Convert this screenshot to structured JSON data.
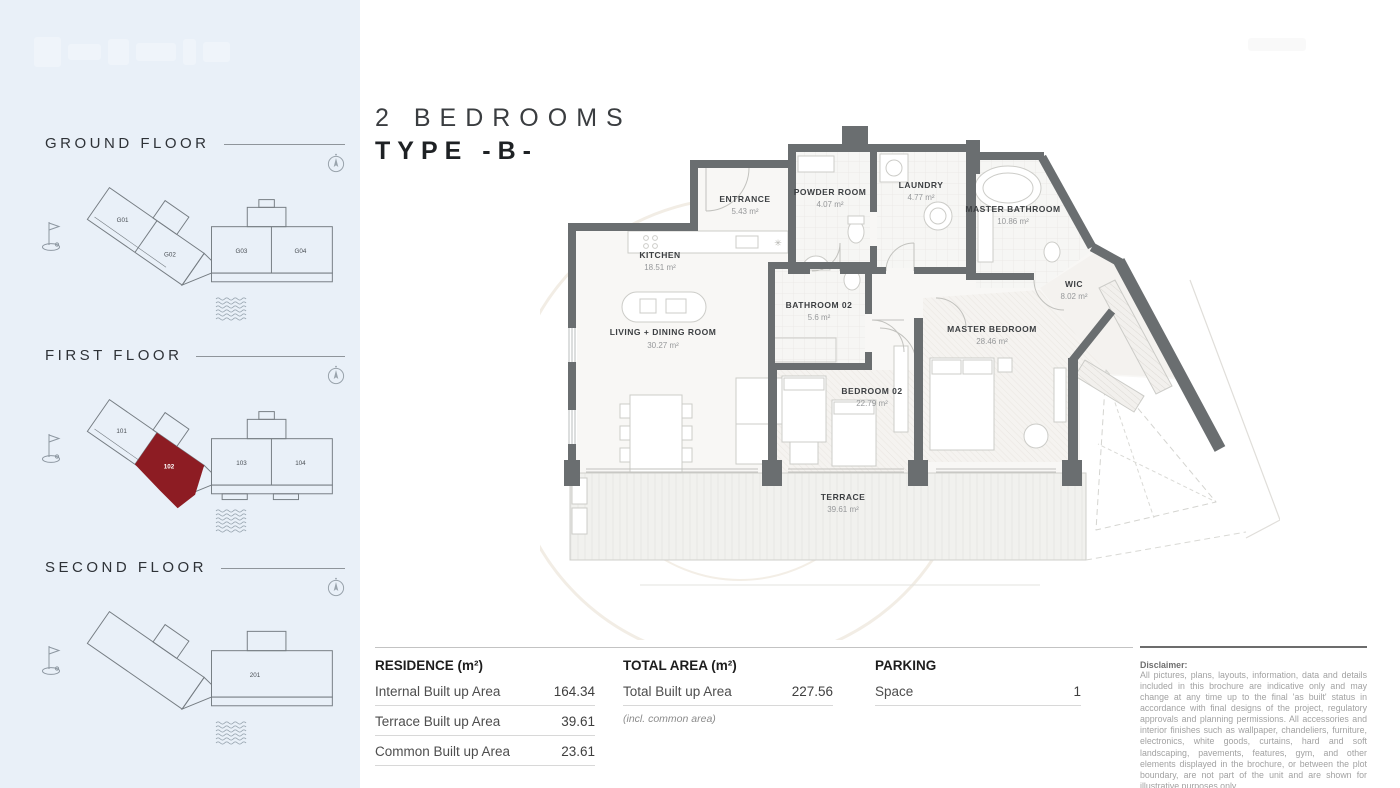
{
  "title": {
    "line1": "2 BEDROOMS",
    "line2": "TYPE -B-"
  },
  "sidebar": {
    "floors": [
      {
        "label": "GROUND FLOOR",
        "units": [
          "G01",
          "G02",
          "G03",
          "G04"
        ],
        "highlighted_unit": ""
      },
      {
        "label": "FIRST FLOOR",
        "units": [
          "101",
          "102",
          "103",
          "104"
        ],
        "highlighted_unit": "102"
      },
      {
        "label": "SECOND FLOOR",
        "units": [
          "201"
        ],
        "highlighted_unit": ""
      }
    ]
  },
  "floorplan": {
    "rooms": [
      {
        "name": "ENTRANCE",
        "area": "5.43 m²"
      },
      {
        "name": "POWDER ROOM",
        "area": "4.07 m²"
      },
      {
        "name": "LAUNDRY",
        "area": "4.77 m²"
      },
      {
        "name": "MASTER BATHROOM",
        "area": "10.86 m²"
      },
      {
        "name": "KITCHEN",
        "area": "18.51 m²"
      },
      {
        "name": "WIC",
        "area": "8.02 m²"
      },
      {
        "name": "LIVING + DINING ROOM",
        "area": "30.27 m²"
      },
      {
        "name": "BATHROOM 02",
        "area": "5.6 m²"
      },
      {
        "name": "MASTER BEDROOM",
        "area": "28.46 m²"
      },
      {
        "name": "BEDROOM 02",
        "area": "22.79 m²"
      },
      {
        "name": "TERRACE",
        "area": "39.61 m²"
      }
    ]
  },
  "tables": {
    "residence": {
      "header": "RESIDENCE (m²)",
      "rows": [
        {
          "label": "Internal Built up Area",
          "value": "164.34"
        },
        {
          "label": "Terrace Built up Area",
          "value": "39.61"
        },
        {
          "label": "Common Built up Area",
          "value": "23.61"
        }
      ]
    },
    "total": {
      "header": "TOTAL AREA (m²)",
      "rows": [
        {
          "label": "Total Built up Area",
          "value": "227.56"
        }
      ],
      "note": "(incl. common area)"
    },
    "parking": {
      "header": "PARKING",
      "rows": [
        {
          "label": "Space",
          "value": "1"
        }
      ]
    }
  },
  "disclaimer": {
    "title": "Disclaimer:",
    "body": "All pictures, plans, layouts, information, data and details included in this brochure are indicative only and may change at any time up to the final 'as built' status in accordance with final designs of the project, regulatory approvals and planning permissions. All accessories and interior finishes such as wallpaper, chandeliers, furniture, electronics, white goods, curtains, hard and soft landscaping, pavements, features, gym, and other elements displayed in the brochure, or between the plot boundary, are not part of the unit and are shown for illustrative purposes only."
  },
  "colors": {
    "accent_red": "#8d1c23",
    "wall_gray": "#6a6e70",
    "sidebar_bg": "#e9f0f8"
  }
}
